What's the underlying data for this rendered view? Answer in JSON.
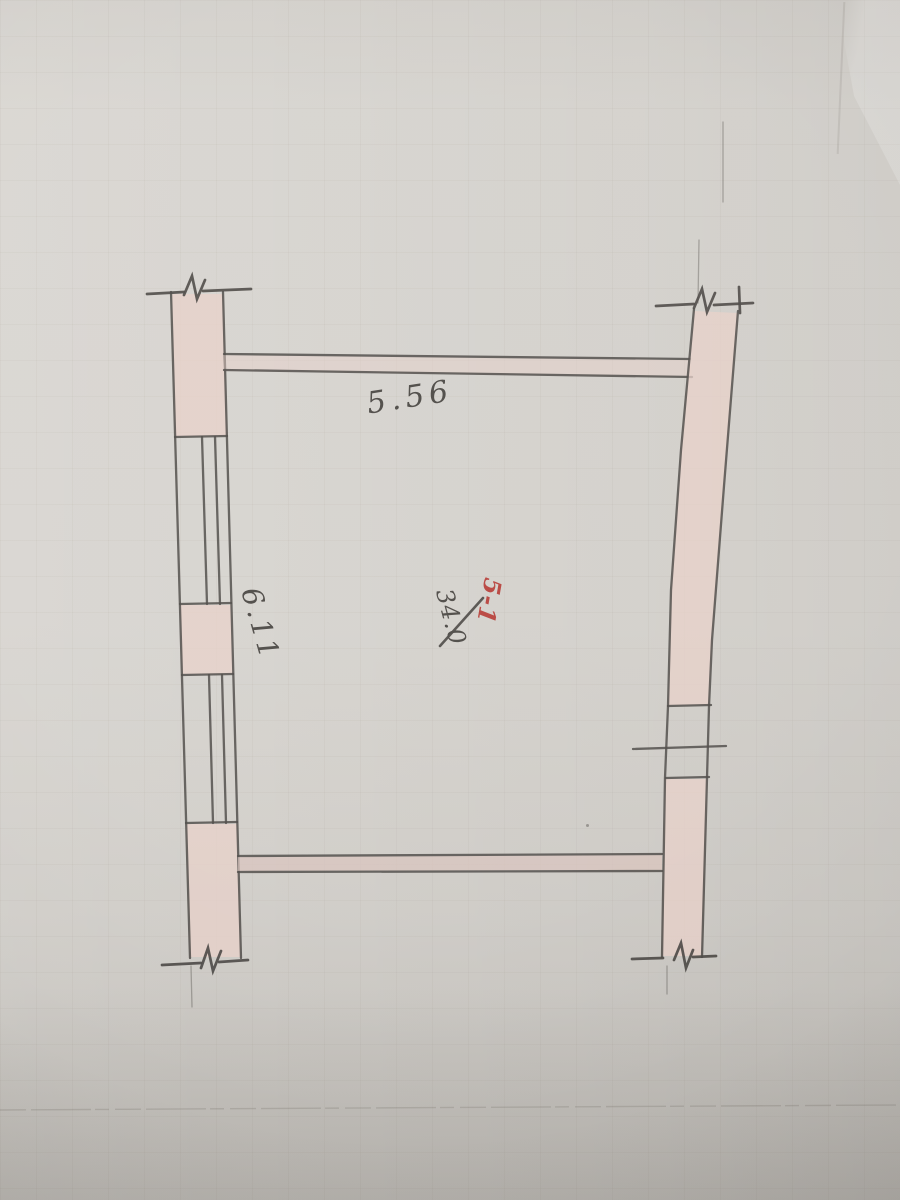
{
  "page": {
    "description": "Hand-drawn floor plan sketch in pencil on photographed graph paper",
    "room": {
      "number": "5-1",
      "area": "34.0"
    },
    "dimensions": {
      "top_width": "5.56",
      "left_height": "6.11"
    },
    "colors": {
      "paper": "#d5d2cd",
      "pencil": "#4a4743",
      "wall_fill_pink": "#e7cfc7",
      "room_number_red": "#b7413b"
    },
    "symbols": [
      "wall-break-mark-top-left",
      "wall-break-mark-top-right",
      "wall-break-mark-bottom-left",
      "wall-break-mark-bottom-right",
      "window-double-line-left-wall",
      "door-opening-right-wall"
    ]
  }
}
